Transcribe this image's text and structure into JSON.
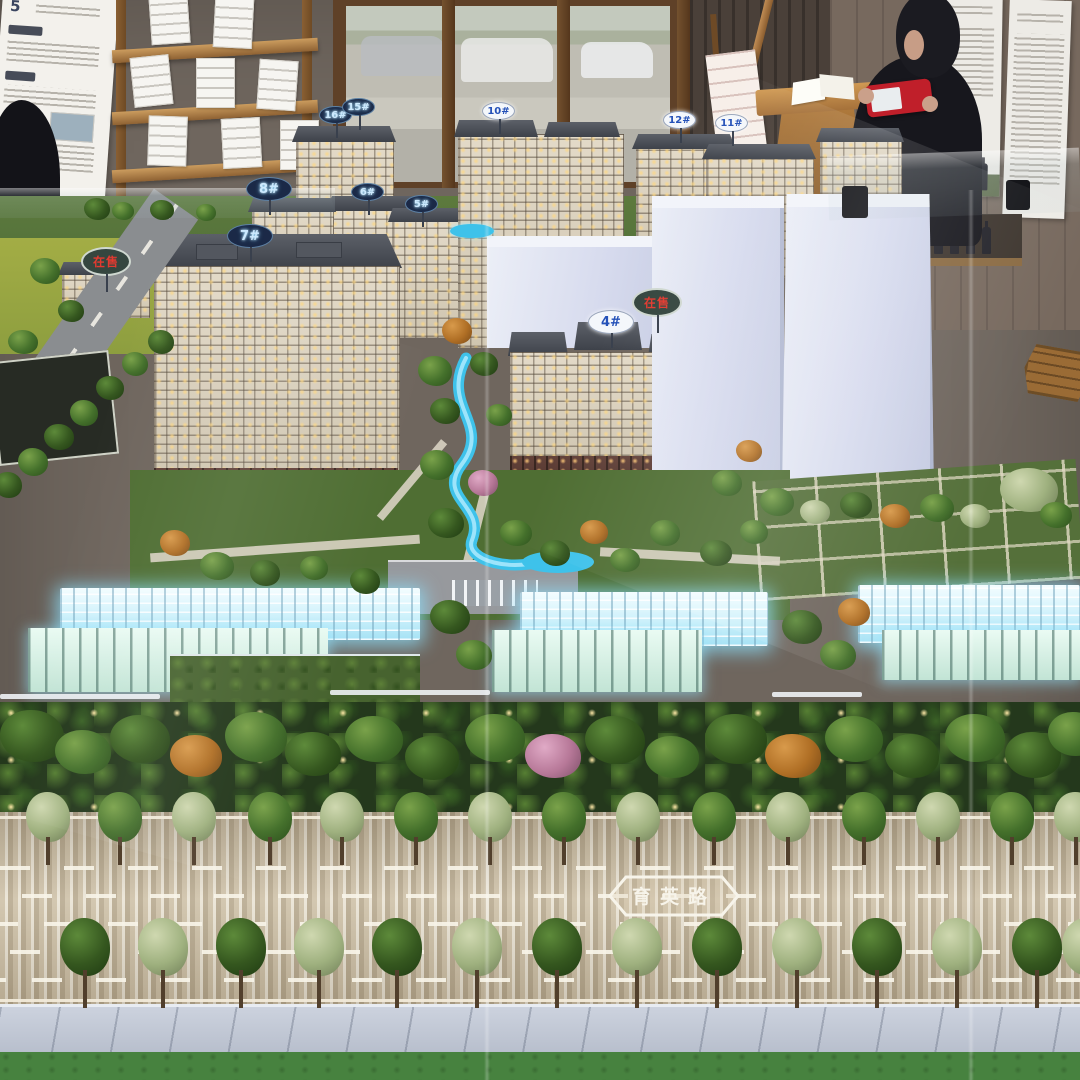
{
  "scene_type": "photo-of-architectural-sales-model",
  "model": {
    "road_name_sign": "育英路",
    "on_sale_label": "在售",
    "building_badges": [
      {
        "label": "8#"
      },
      {
        "label": "7#"
      },
      {
        "label": "4#"
      },
      {
        "label": "16#"
      },
      {
        "label": "15#"
      },
      {
        "label": "10#"
      },
      {
        "label": "6#"
      },
      {
        "label": "5#"
      },
      {
        "label": "12#"
      },
      {
        "label": "11#"
      }
    ]
  },
  "room": {
    "left_poster_heading_fragment": "5"
  }
}
